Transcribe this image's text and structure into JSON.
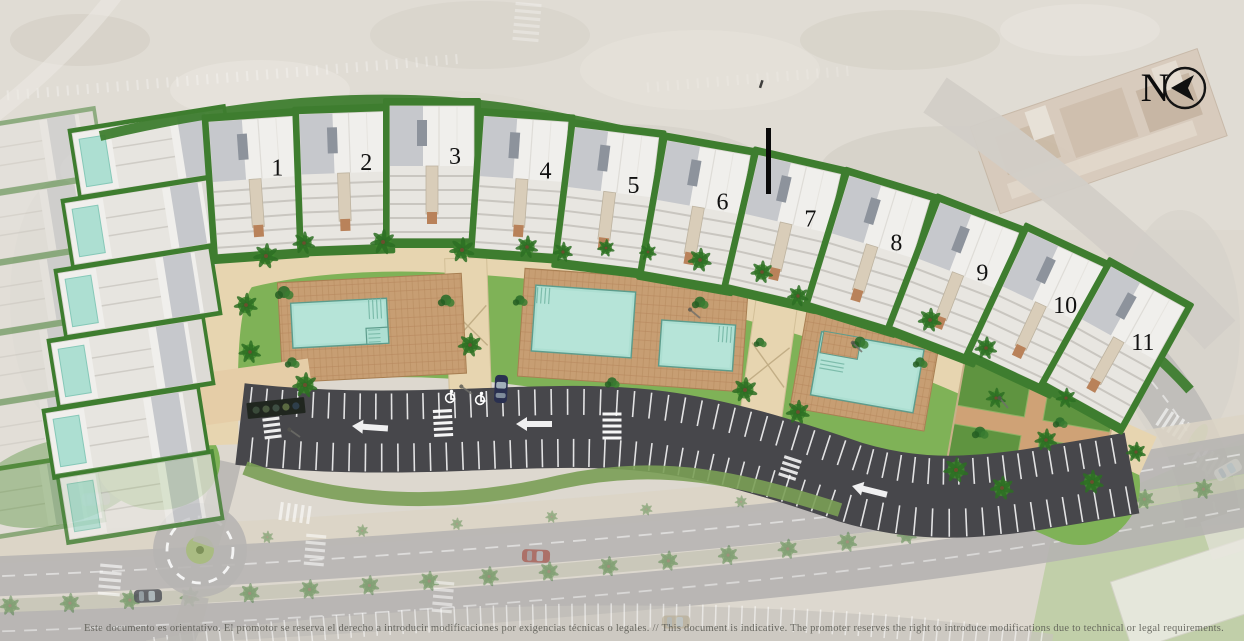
{
  "compass": {
    "label": "N"
  },
  "units": [
    {
      "label": "1"
    },
    {
      "label": "2"
    },
    {
      "label": "3"
    },
    {
      "label": "4"
    },
    {
      "label": "5"
    },
    {
      "label": "6"
    },
    {
      "label": "7"
    },
    {
      "label": "8"
    },
    {
      "label": "9"
    },
    {
      "label": "10"
    },
    {
      "label": "11"
    }
  ],
  "legend": {
    "disclaimer": "Este documento es orientativo. El promotor se reserva el derecho a introducir modificaciones por exigencias técnicas o legales. // This document is indicative. The promoter reserves the right to introduce modifications due to technical or legal requirements."
  },
  "colors": {
    "sand": "#ddd8cf",
    "lawn": "#7fb257",
    "lawn_dark": "#4f8a38",
    "hedge": "#3e7d2f",
    "deck": "#c79e73",
    "deck_line": "#b5875c",
    "water": "#addfd2",
    "water_edge": "#5d9c8c",
    "promenade": "#e7d5b0",
    "asphalt": "#47474b",
    "road": "#b7b5b2",
    "sidewalk": "#dcd5c6",
    "roof": "#f0efec",
    "roof_panel": "#c6c8cc",
    "stripe": "#ffffff",
    "number": "#111111",
    "marker": "#0a0a0a",
    "village": "#d7c9ba"
  }
}
